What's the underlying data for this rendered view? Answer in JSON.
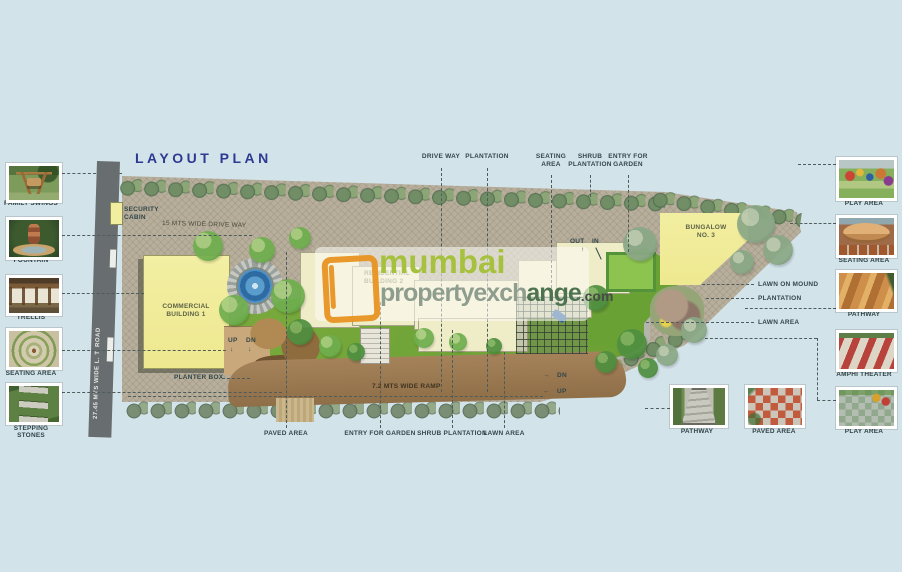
{
  "title": "LAYOUT PLAN",
  "watermark": {
    "brand_top": "mumbai",
    "brand_mid": "propertyexch",
    "brand_mid2": "ange",
    "brand_suffix": ".com"
  },
  "road": {
    "label": "27.45 MTS WIDE L. T. ROAD"
  },
  "plan": {
    "security_cabin": "SECURITY\nCABIN",
    "drive_way": "15 MTS WIDE DRIVE WAY",
    "commercial": "COMMERCIAL\nBUILDING 1",
    "residential": "RESIDENTIAL\nBUILDING 2",
    "bungalow": "BUNGALOW\nNO. 3",
    "planter_box": "PLANTER BOX",
    "ramp": "7.2 MTS WIDE RAMP",
    "up": "UP",
    "dn": "DN",
    "out": "OUT",
    "in": "IN",
    "ramp_dn": "DN",
    "ramp_up": "UP"
  },
  "icons": {
    "arrow_down": "↓",
    "arrow_up": "↑",
    "arrow_right": "→",
    "arrow_left": "←"
  },
  "callouts": {
    "top": [
      {
        "label": "DRIVE WAY"
      },
      {
        "label": "PLANTATION"
      },
      {
        "label": "SEATING\nAREA"
      },
      {
        "label": "SHRUB\nPLANTATION"
      },
      {
        "label": "ENTRY FOR\nGARDEN"
      }
    ],
    "bottom": [
      {
        "label": "PAVED AREA"
      },
      {
        "label": "ENTRY FOR GARDEN"
      },
      {
        "label": "SHRUB PLANTATION"
      },
      {
        "label": "LAWN AREA"
      }
    ],
    "right": [
      {
        "label": "LAWN ON MOUND"
      },
      {
        "label": "PLANTATION"
      },
      {
        "label": "LAWN AREA"
      }
    ]
  },
  "left_gallery": [
    {
      "label": "FAMILY SWINGS"
    },
    {
      "label": "FOUNTAIN"
    },
    {
      "label": "TRELLIS"
    },
    {
      "label": "SEATING AREA"
    },
    {
      "label": "STEPPING STONES"
    }
  ],
  "right_gallery": [
    {
      "label": "PLAY AREA"
    },
    {
      "label": "SEATING AREA"
    },
    {
      "label": "PATHWAY"
    },
    {
      "label": "AMPHI THEATER"
    },
    {
      "label": "PLAY AREA"
    }
  ],
  "bottom_gallery": [
    {
      "label": "PATHWAY"
    },
    {
      "label": "PAVED AREA"
    }
  ],
  "colors": {
    "background": "#d3e3ea",
    "site": "#b7ae9b",
    "lawn": "#74a437",
    "building": "#f2ee9f",
    "ramp": "#a07e52",
    "road": "#686d70",
    "title": "#2d3a92",
    "brand_orange": "#e8911d",
    "brand_green": "#a6c13d"
  }
}
